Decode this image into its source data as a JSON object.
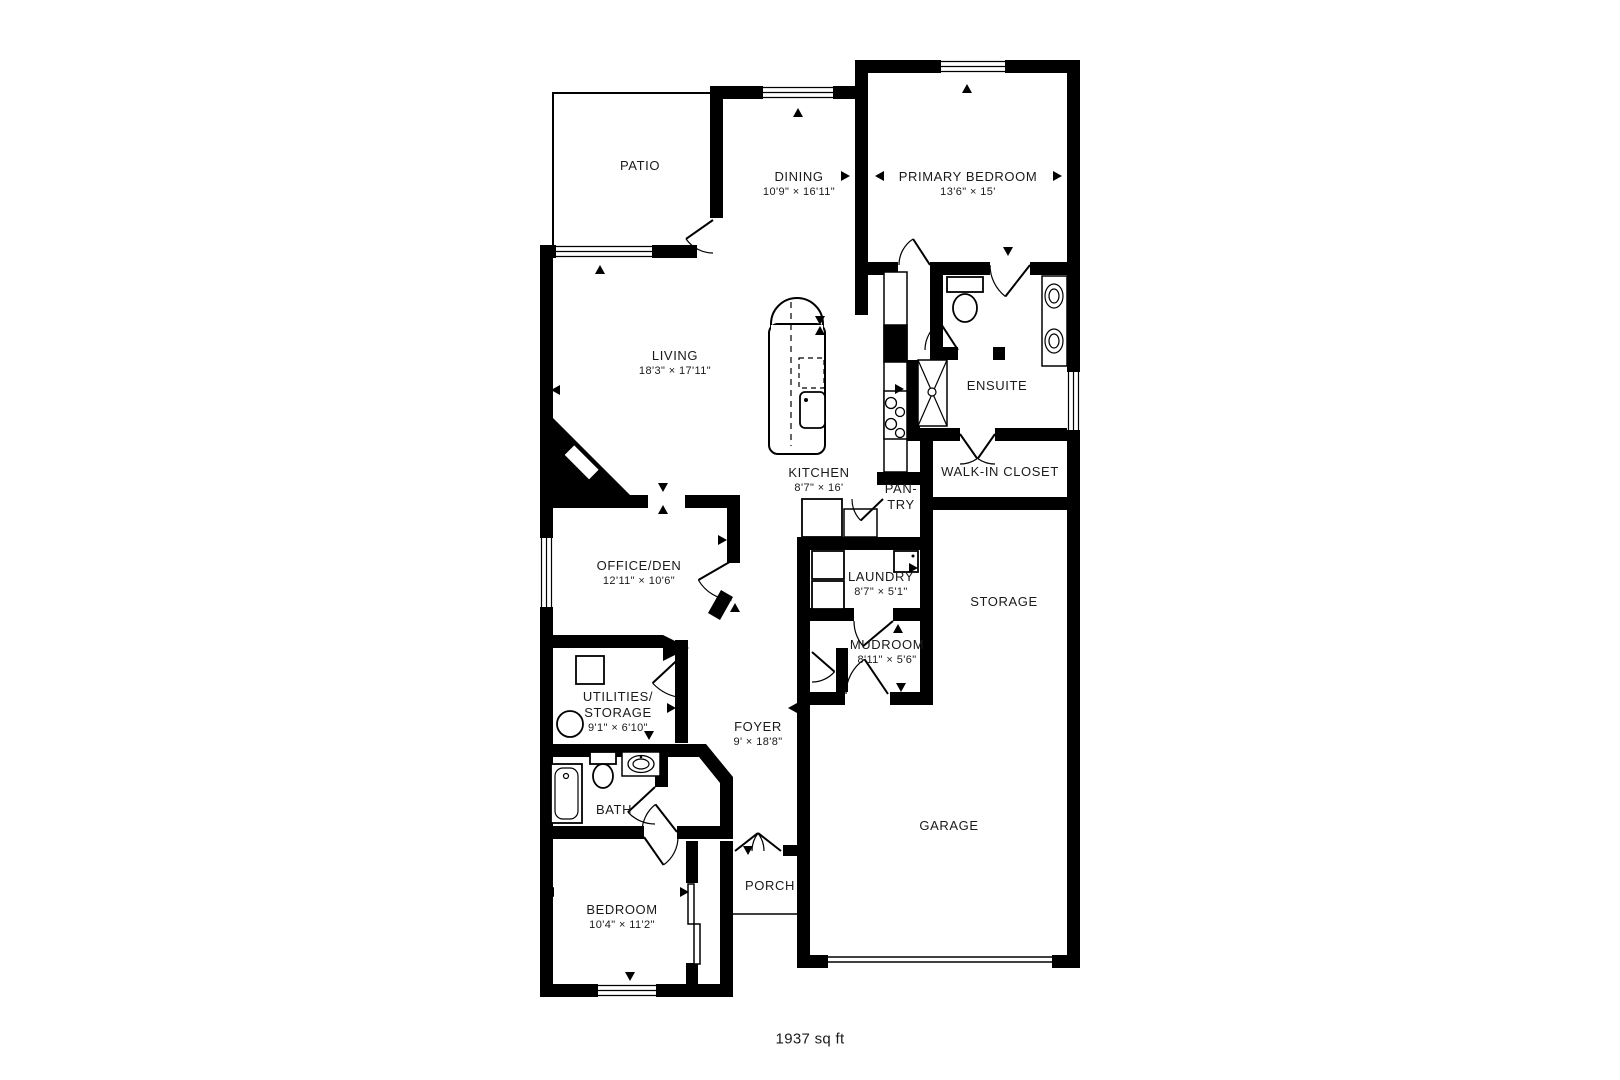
{
  "footer": {
    "area": "1937 sq ft"
  },
  "rooms": [
    {
      "id": "patio",
      "name": "PATIO",
      "dims": ""
    },
    {
      "id": "dining",
      "name": "DINING",
      "dims": "10'9\" × 16'11\""
    },
    {
      "id": "primary",
      "name": "PRIMARY BEDROOM",
      "dims": "13'6\" × 15'"
    },
    {
      "id": "living",
      "name": "LIVING",
      "dims": "18'3\" × 17'11\""
    },
    {
      "id": "ensuite",
      "name": "ENSUITE",
      "dims": ""
    },
    {
      "id": "wic",
      "name": "WALK-IN CLOSET",
      "dims": ""
    },
    {
      "id": "kitchen",
      "name": "KITCHEN",
      "dims": "8'7\" × 16'"
    },
    {
      "id": "pantry",
      "name": "PAN-",
      "name2": "TRY",
      "dims": ""
    },
    {
      "id": "office",
      "name": "OFFICE/DEN",
      "dims": "12'11\" × 10'6\""
    },
    {
      "id": "laundry",
      "name": "LAUNDRY",
      "dims": "8'7\" × 5'1\""
    },
    {
      "id": "storage",
      "name": "STORAGE",
      "dims": ""
    },
    {
      "id": "mudroom",
      "name": "MUDROOM",
      "dims": "8'11\" × 5'6\""
    },
    {
      "id": "utilities",
      "name": "UTILITIES/",
      "name2": "STORAGE",
      "dims": "9'1\" × 6'10\""
    },
    {
      "id": "foyer",
      "name": "FOYER",
      "dims": "9' × 18'8\""
    },
    {
      "id": "bath",
      "name": "BATH",
      "dims": ""
    },
    {
      "id": "porch",
      "name": "PORCH",
      "dims": ""
    },
    {
      "id": "bedroom",
      "name": "BEDROOM",
      "dims": "10'4\" × 11'2\""
    },
    {
      "id": "garage",
      "name": "GARAGE",
      "dims": ""
    }
  ]
}
